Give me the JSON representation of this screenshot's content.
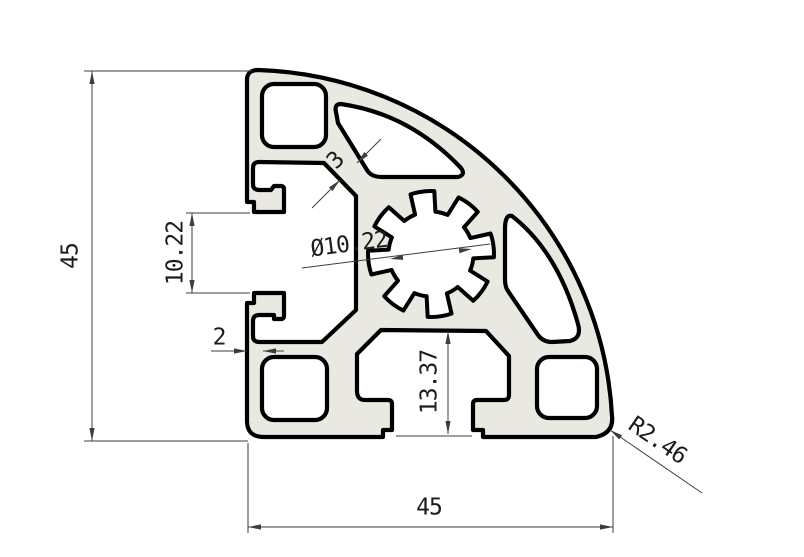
{
  "drawing": {
    "type": "technical-cross-section",
    "subject": "aluminium extrusion corner profile 45x45 with T-slots and round outer corner",
    "colors": {
      "background": "#ffffff",
      "profile_fill": "#e9e9e1",
      "outline": "#000000",
      "dimension_lines": "#3d3d3d"
    },
    "dimensions": {
      "height": {
        "label": "45"
      },
      "width": {
        "label": "45"
      },
      "slot_opening": {
        "label": "10.22"
      },
      "wall_thickness": {
        "label": "2"
      },
      "web_thickness": {
        "label": "3"
      },
      "center_bore": {
        "label": "Ø10.22"
      },
      "slot_depth": {
        "label": "13.37"
      },
      "corner_radius": {
        "label": "R2.46"
      }
    }
  }
}
